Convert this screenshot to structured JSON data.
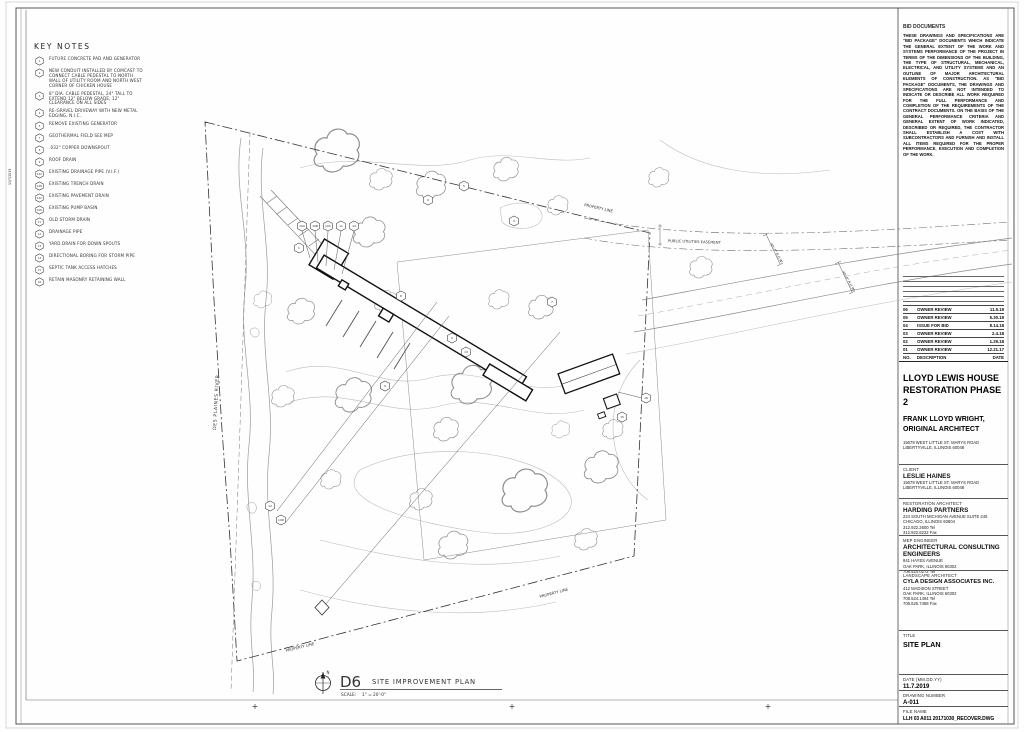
{
  "sheet": {
    "plot_stamp": "11/7/2019"
  },
  "keynotes": {
    "title": "KEY NOTES",
    "items": [
      {
        "num": "1",
        "text": "FUTURE CONCRETE PAD AND GENERATOR"
      },
      {
        "num": "2",
        "text": "NEW CONDUIT INSTALLED BY COMCAST TO CONNECT CABLE PEDESTAL TO NORTH WALL OF UTILITY ROOM AND NORTH WEST CORNER OF CHICKEN HOUSE"
      },
      {
        "num": "3",
        "text": "8\" DIA. CABLE PEDESTAL, 24\" TALL TO EXTEND 12\" BELOW GRADE, 12\" CLEARANCE ON ALL SIDES"
      },
      {
        "num": "4",
        "text": "RE-GRAVEL DRIVEWAY WITH NEW METAL EDGING, N.I.C."
      },
      {
        "num": "5",
        "text": "REMOVE EXISTING GENERATOR"
      },
      {
        "num": "7",
        "text": "GEOTHERMAL FIELD SEE MEP"
      },
      {
        "num": "8",
        "text": ".032\" COPPER DOWNSPOUT"
      },
      {
        "num": "9",
        "text": "ROOF DRAIN"
      },
      {
        "num": "10A",
        "text": "EXISTING DRAINAGE PIPE (V.I.F.)"
      },
      {
        "num": "10B",
        "text": "EXISTING TRENCH DRAIN"
      },
      {
        "num": "10C",
        "text": "EXISTING PAVEMENT DRAIN"
      },
      {
        "num": "10D",
        "text": "EXISTING PUMP BASIN"
      },
      {
        "num": "11",
        "text": "OLD STORM DRAIN"
      },
      {
        "num": "12",
        "text": "DRAINAGE PIPE"
      },
      {
        "num": "13",
        "text": "YARD DRAIN FOR DOWN SPOUTS"
      },
      {
        "num": "14",
        "text": "DIRECTIONAL BORING FOR STORM PIPE"
      },
      {
        "num": "15",
        "text": "SEPTIC TANK ACCESS HATCHES"
      },
      {
        "num": "16",
        "text": "RETAIN MASONRY RETAINING WALL"
      }
    ]
  },
  "bid_note": {
    "title": "BID DOCUMENTS",
    "body": "THESE DRAWINGS AND SPECIFICATIONS ARE \"BID PACKAGE\" DOCUMENTS WHICH INDICATE THE GENERAL EXTENT OF THE WORK AND SYSTEMS PERFORMANCE OF THE PROJECT IN TERMS OF THE DIMENSIONS OF THE BUILDING, THE TYPE OF STRUCTURAL, MECHANICAL, ELECTRICAL, AND UTILITY SYSTEMS AND AN OUTLINE OF MAJOR ARCHITECTURAL ELEMENTS OF CONSTRUCTION. AS \"BID PACKAGE\" DOCUMENTS, THE DRAWINGS AND SPECIFICATIONS ARE NOT INTENDED TO INDICATE OR DESCRIBE ALL WORK REQUIRED FOR THE FULL PERFORMANCE AND COMPLETION OF THE REQUIREMENTS OF THE CONTRACT DOCUMENTS. ON THE BASIS OF THE GENERAL PERFORMANCE CRITERIA AND GENERAL EXTENT OF WORK INDICATED, DESCRIBED OR REQUIRED, THE CONTRACTOR SHALL ESTABLISH A COST WITH SUBCONTRACTORS AND FURNISH AND INSTALL ALL ITEMS REQUIRED FOR THE PROPER PERFORMANCE, EXECUTION AND COMPLETION OF THE WORK."
  },
  "revisions": {
    "rows": [
      {
        "no": "06",
        "desc": "OWNER REVIEW",
        "date": "11.5.19"
      },
      {
        "no": "05",
        "desc": "OWNER REVIEW",
        "date": "5.30.19"
      },
      {
        "no": "04",
        "desc": "ISSUE FOR BID",
        "date": "8.14.18"
      },
      {
        "no": "03",
        "desc": "OWNER REVIEW",
        "date": "2.4.18"
      },
      {
        "no": "02",
        "desc": "OWNER REVIEW",
        "date": "1.29.18"
      },
      {
        "no": "01",
        "desc": "OWNER REVIEW",
        "date": "12.21.17"
      },
      {
        "no": "NO.",
        "desc": "DESCRIPTION",
        "date": "DATE"
      }
    ]
  },
  "project": {
    "title_line1": "LLOYD LEWIS HOUSE",
    "title_line2": "RESTORATION PHASE 2",
    "architect_line1": "FRANK LLOYD WRIGHT,",
    "architect_line2": "ORIGINAL ARCHITECT",
    "address_line1": "15679 WEST LITTLE ST. MARYS ROAD",
    "address_line2": "LIBERTYVILLE, ILLINOIS 60048"
  },
  "client": {
    "label": "CLIENT",
    "name": "LESLIE HAINES",
    "addr1": "15679 WEST LITTLE ST. MARYS ROAD",
    "addr2": "LIBERTYVILLE, ILLINOIS 60048"
  },
  "restoration_architect": {
    "label": "RESTORATION ARCHITECT",
    "name": "HARDING PARTNERS",
    "addr1": "224 SOUTH MICHIGAN AVENUE SUITE 245",
    "addr2": "CHICAGO, ILLINOIS 60604",
    "tel": "312.922.2600 Tel",
    "fax": "312.922.8222 Fax"
  },
  "mep_engineer": {
    "label": "MEP ENGINEER",
    "name1": "ARCHITECTURAL CONSULTING",
    "name2": "ENGINEERS",
    "addr1": "841 HAYES AVENUE",
    "addr2": "OAK PARK, ILLINOIS 60302",
    "tel": "708.524.0272 Tel"
  },
  "landscape_architect": {
    "label": "LANDSCAPE ARCHITECT",
    "name": "CYLA DESIGN ASSOCIATES INC.",
    "addr1": "412 MADISON STREET",
    "addr2": "OAK PARK, ILLINOIS 60302",
    "tel": "708.524.1494 Tel",
    "fax": "708.525.7488 Fax"
  },
  "titleblock": {
    "title_label": "TITLE",
    "title_value": "SITE PLAN",
    "date_label": "DATE (MM.DD.YY)",
    "date_value": "11.7.2019",
    "number_label": "DRAWING NUMBER",
    "number_value": "A-011",
    "file_label": "FILE NAME",
    "file_value": "LLH 03 A011 20171030_RECOVER.DWG"
  },
  "plan": {
    "drawing_id": "D6",
    "drawing_title": "SITE IMPROVEMENT PLAN",
    "scale_label": "SCALE:",
    "scale_value": "1\" = 20'-0\"",
    "north_label": "N",
    "labels": {
      "property_line": "PROPERTY LINE",
      "easement": "PUBLIC UTILITIES EASEMENT",
      "river": "DES PLAINES RIVER",
      "row_dim": "40'-0\" R.O.W."
    },
    "callouts": [
      "4",
      "5",
      "3",
      "2",
      "1",
      "7",
      "8",
      "9",
      "13",
      "16",
      "15",
      "12",
      "10D",
      "10A",
      "10B",
      "10C",
      "11",
      "14"
    ]
  }
}
